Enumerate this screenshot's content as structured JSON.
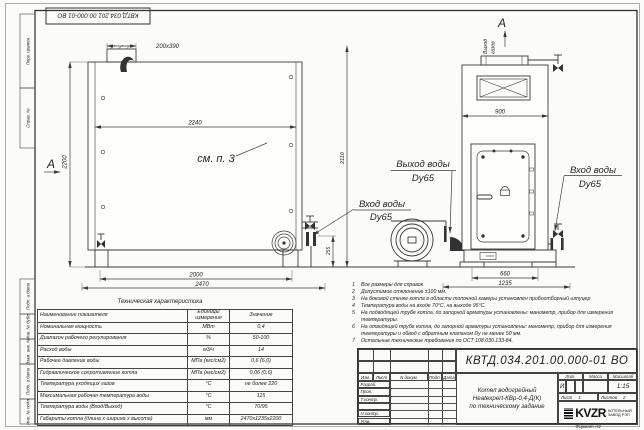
{
  "sheet": {
    "doc_number_flipped": "КВТД.034.201.00.000-01 ВО",
    "format_note": "Формат А3"
  },
  "margin": [
    "Перв. примен.",
    "Справ. №",
    "Подп. и дата",
    "Инв. № дубл.",
    "Взам. инв. №",
    "Подп. и дата",
    "Инв. № подл."
  ],
  "drawing": {
    "view_marker_left": "А",
    "view_marker_top": "А",
    "see_note": "см. п. 3",
    "gas_outlet_word1": "Выход",
    "gas_outlet_word2": "газов",
    "inlet_left_line1": "Вход воды",
    "inlet_left_line2": "Dy65",
    "outlet_line1": "Выход воды",
    "outlet_line2": "Dy65",
    "inlet_right_line1": "Вход воды",
    "inlet_right_line2": "Dy65",
    "dims": {
      "top_stub": "200x390",
      "inner_width": "2240",
      "height": "2200",
      "total_height": "2110",
      "base_width": "2000",
      "total_length": "2470",
      "outlet_height": "255",
      "side_width": "900",
      "side_base": "660",
      "side_length": "1235"
    }
  },
  "notes": [
    {
      "num": "1",
      "text": "Все размеры для справок"
    },
    {
      "num": "2",
      "text": "Допустимое отклонение ±100 мм."
    },
    {
      "num": "3",
      "text": "На боковой стенке котла в области топочной камеры установлен пробоотборный штуцер"
    },
    {
      "num": "4",
      "text": "Температура воды на входе 70°С, на выходе 95°С."
    },
    {
      "num": "5",
      "text": "На подводящей трубе котла, до запорной арматуры установлены: манометр, прибор для измерения температуры."
    },
    {
      "num": "6",
      "text": "На отводящей трубе котла, до запорной арматуры установлены: манометр, прибор для измерения температуры и обвод с обратным клапаном Dу не менее 50 мм."
    },
    {
      "num": "7",
      "text": "Остальные технические требования по ОСТ 108.030.133-84."
    }
  ],
  "tech_table": {
    "title": "Техническая характеристика",
    "headers": {
      "name": "Наименование показателя",
      "units": "Единицы измерения",
      "value": "Значение"
    },
    "rows": [
      {
        "name": "Номинальная мощность",
        "units": "МВт",
        "value": "0,4"
      },
      {
        "name": "Диапазон рабочего регулирования",
        "units": "%",
        "value": "50-100"
      },
      {
        "name": "Расход воды",
        "units": "м3/ч",
        "value": "14"
      },
      {
        "name": "Рабочее давление воды",
        "units": "МПа (кгс/см2)",
        "value": "0,6 (6,0)"
      },
      {
        "name": "Гидравлическое сопротивление котла",
        "units": "МПа (кгс/см2)",
        "value": "0,06 (0,6)"
      },
      {
        "name": "Температура уходящих газов",
        "units": "°С",
        "value": "не более 220"
      },
      {
        "name": "Максимальная рабочая температура воды",
        "units": "°С",
        "value": "115"
      },
      {
        "name": "Температура воды (Вход/Выход)",
        "units": "°С",
        "value": "70/95"
      },
      {
        "name": "Габариты котла (длина х ширина х высота)",
        "units": "мм",
        "value": "2470х1235х2200"
      }
    ]
  },
  "title_block": {
    "doc_number": "КВТД.034.201.00.000-01 ВО",
    "product_line1": "Котел водогрейный",
    "product_line2": "Heatexpert-КВр-0,4-Д(К)",
    "product_line3": "по техническому задание",
    "cols": [
      "Изм.",
      "Лист",
      "N докум.",
      "Подп.",
      "Дата"
    ],
    "rows": [
      "Разраб.",
      "Пров.",
      "Т.контр.",
      "",
      "Н.контр.",
      "Утв."
    ],
    "lit_label": "Лит.",
    "mass_label": "Масса",
    "scale_label": "Масштаб",
    "lit": "И",
    "scale": "1:15",
    "sheet_label": "Лист",
    "sheet": "1",
    "sheets_label": "Листов",
    "sheets": "2",
    "logo": "KVZR",
    "company_line1": "КОТЕЛЬНЫЙ",
    "company_line2": "ЗАВОД РЭП"
  }
}
